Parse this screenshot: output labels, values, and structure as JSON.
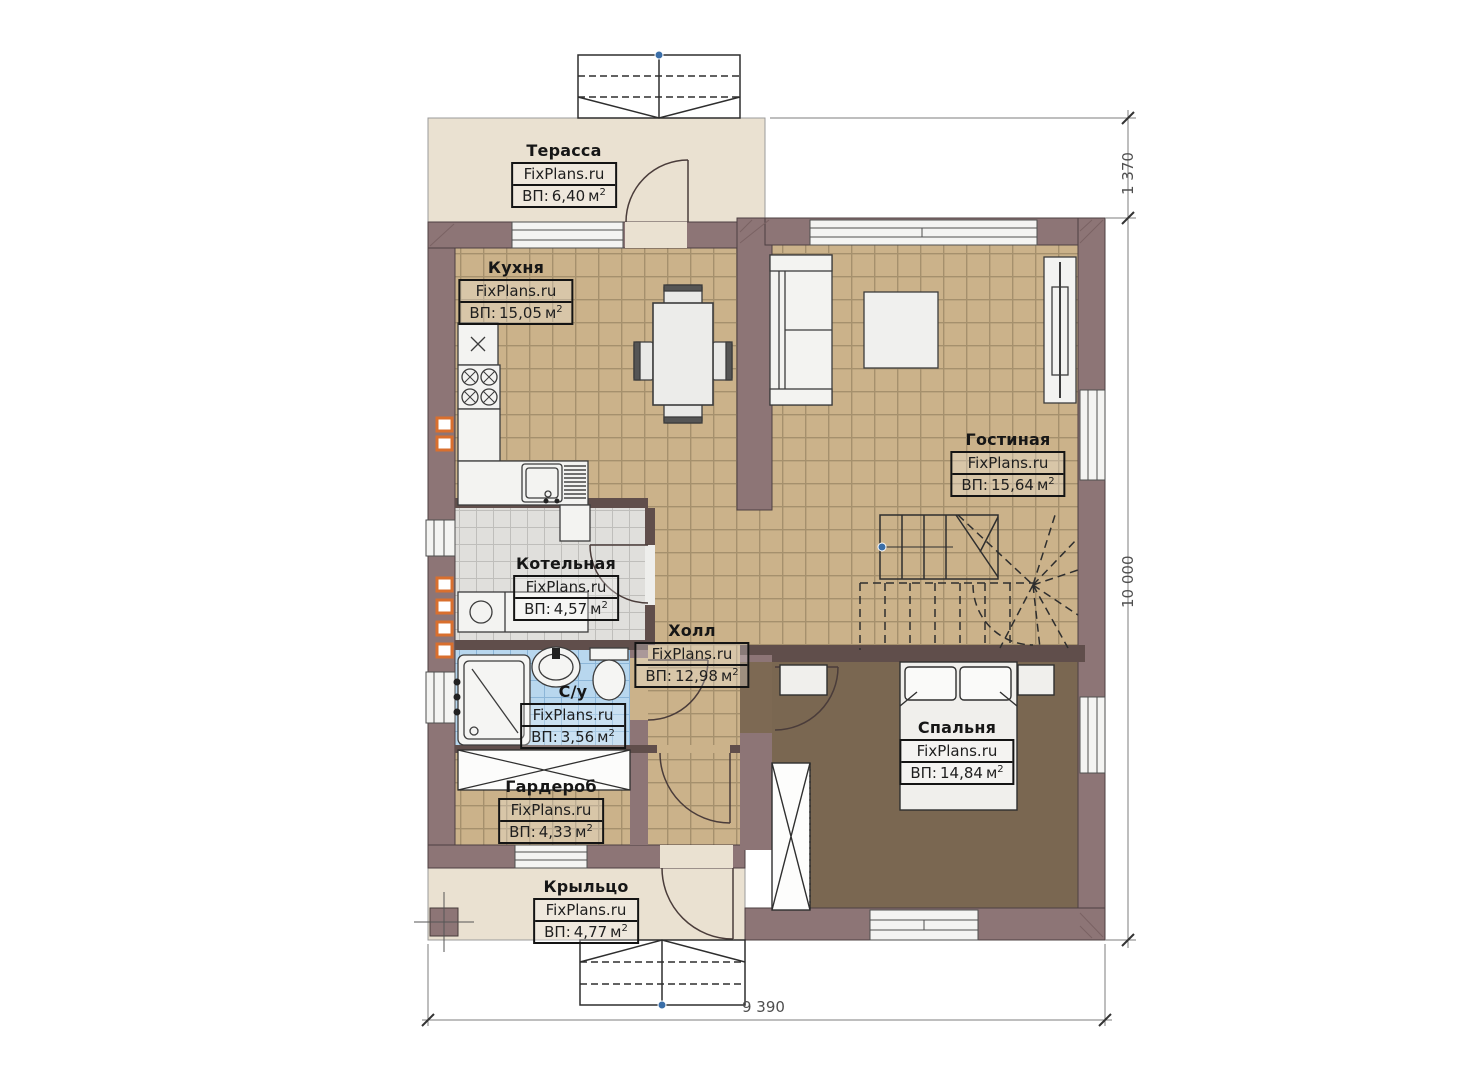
{
  "site": {
    "watermark": "FixPlans.ru"
  },
  "labels": {
    "area_prefix": "ВП:",
    "unit": "м",
    "sup": "2"
  },
  "rooms": [
    {
      "id": "terrace",
      "name": "Терасса",
      "area": "6,40"
    },
    {
      "id": "kitchen",
      "name": "Кухня",
      "area": "15,05"
    },
    {
      "id": "living",
      "name": "Гостиная",
      "area": "15,64"
    },
    {
      "id": "boiler",
      "name": "Котельная",
      "area": "4,57"
    },
    {
      "id": "hall",
      "name": "Холл",
      "area": "12,98"
    },
    {
      "id": "bath",
      "name": "С/у",
      "area": "3,56"
    },
    {
      "id": "bedroom",
      "name": "Спальня",
      "area": "14,84"
    },
    {
      "id": "wardrobe",
      "name": "Гардероб",
      "area": "4,33"
    },
    {
      "id": "porch",
      "name": "Крыльцо",
      "area": "4,77"
    }
  ],
  "dimensions": {
    "terrace_depth": "1 370",
    "house_length": "10 000",
    "house_width": "9 390"
  },
  "colors": {
    "wall": "#8d7576",
    "floor_tile_tan": "#cbb28a",
    "floor_tile_gray": "#e0dfdc",
    "floor_tile_blue": "#b8d7ee",
    "floor_bedroom": "#7d6953",
    "terrace_floor": "#eae1d1",
    "vent_accent": "#d96f2e"
  }
}
